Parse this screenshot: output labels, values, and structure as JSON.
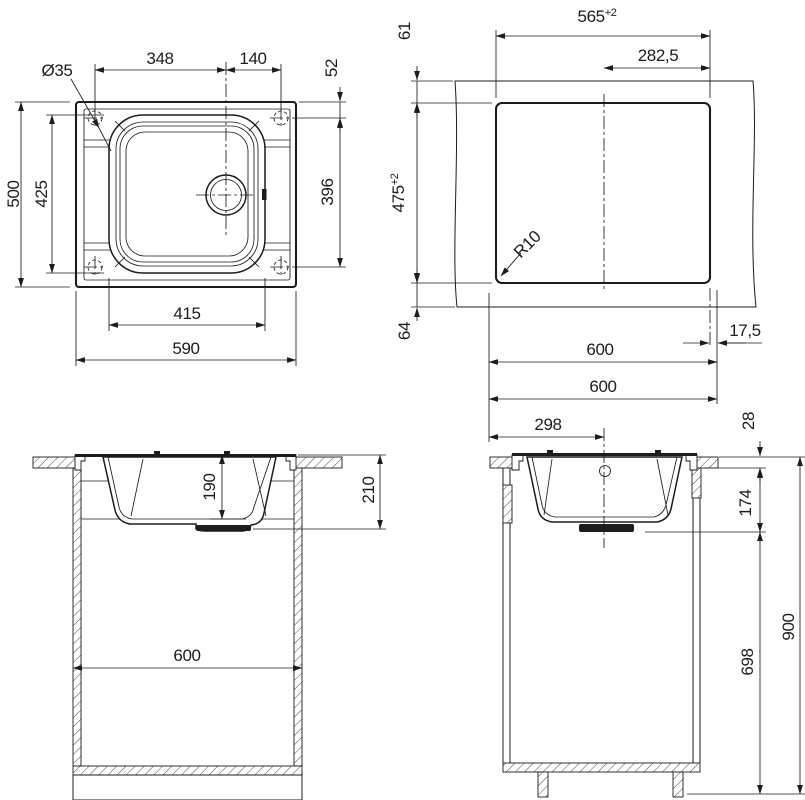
{
  "views": {
    "top": {
      "hole_dia": "Ø35",
      "hole_left_to_drain": "348",
      "drain_to_hole_right": "140",
      "edge_to_hole": "52",
      "hole_span_v": "396",
      "overall_height": "500",
      "bowl_height": "425",
      "bowl_width": "415",
      "overall_width": "590"
    },
    "cutout": {
      "width": "565",
      "width_tol": "+2",
      "center_to_right": "282,5",
      "front_gap": "61",
      "height": "475",
      "height_tol": "+2",
      "back_gap": "64",
      "corner_radius": "R10",
      "sink_width": "600",
      "overhang": "17,5"
    },
    "front": {
      "bowl_depth": "190",
      "total_depth": "210",
      "cabinet_width": "600"
    },
    "side": {
      "worktop_width": "600",
      "edge_to_center": "298",
      "worktop_thickness": "28",
      "depth_below_top": "174",
      "underbody_height": "698",
      "total_height": "900"
    }
  }
}
